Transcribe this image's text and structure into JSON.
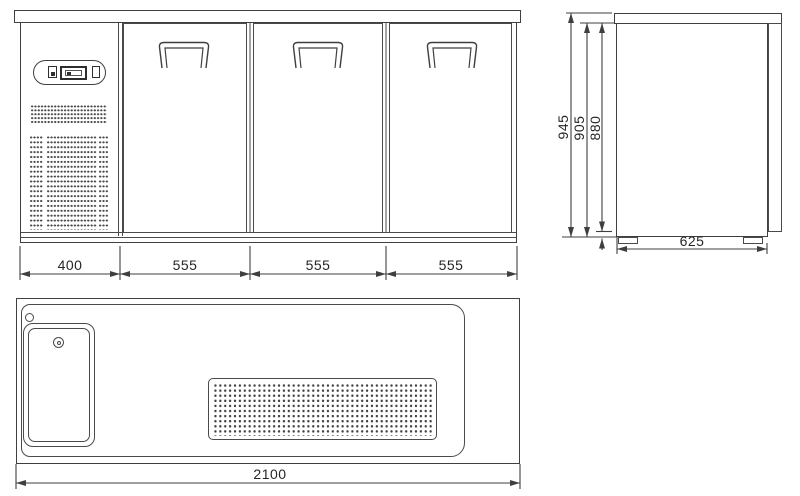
{
  "drawing": {
    "type": "technical-drawing",
    "subject": "three-door-bar-counter-with-sink-top",
    "line_color": "#3f3f3f",
    "background": "#ffffff"
  },
  "front_view": {
    "segment_dims": [
      "400",
      "555",
      "555",
      "555"
    ]
  },
  "side_view": {
    "height_dims": [
      "945",
      "905",
      "880"
    ],
    "depth_dim": "625"
  },
  "plan_view": {
    "width_dim": "2100"
  }
}
